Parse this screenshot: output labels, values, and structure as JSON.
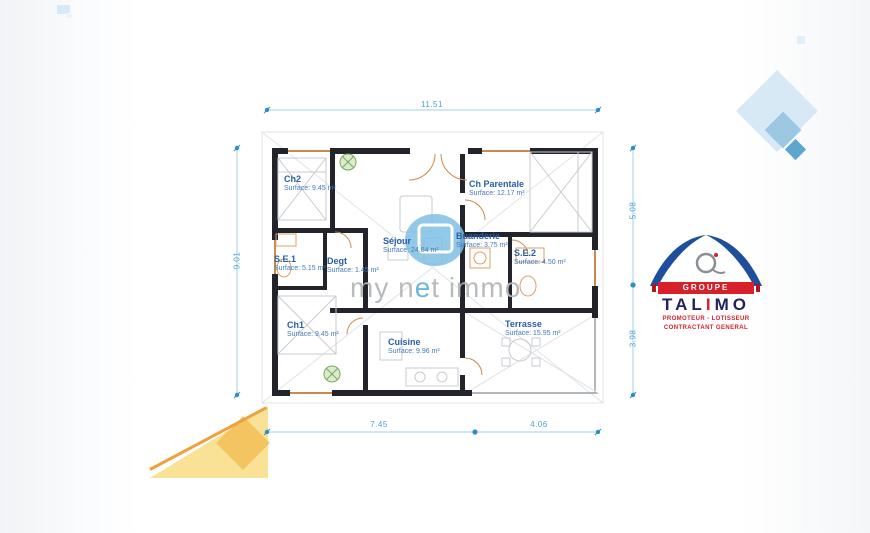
{
  "dimensions": {
    "top": "11.51",
    "left": "9.01",
    "right_upper": "5.08",
    "right_lower": "3.98",
    "bottom_left": "7.45",
    "bottom_right": "4.06"
  },
  "rooms": [
    {
      "name": "Ch2",
      "surface": "Surface: 9.45 m²"
    },
    {
      "name": "Ch Parentale",
      "surface": "Surface: 12.17 m²"
    },
    {
      "name": "Séjour",
      "surface": "Surface: 24.84 m²"
    },
    {
      "name": "Buanderie",
      "surface": "Surface: 3.75 m²"
    },
    {
      "name": "S.E.1",
      "surface": "Surface: 5.15 m²"
    },
    {
      "name": "Degt",
      "surface": "Surface: 1.45 m²"
    },
    {
      "name": "S.E.2",
      "surface": "Surface: 4.50 m²"
    },
    {
      "name": "Ch1",
      "surface": "Surface: 9.45 m²"
    },
    {
      "name": "Cuisine",
      "surface": "Surface: 9.96 m²"
    },
    {
      "name": "Terrasse",
      "surface": "Surface: 15.95 m²"
    }
  ],
  "watermark": {
    "prefix": "my n",
    "accent": "e",
    "suffix": "t immo"
  },
  "logo": {
    "groupe": "GROUPE",
    "talimo": [
      "TAL",
      "I",
      "MO"
    ],
    "subtitle1": "PROMOTEUR - LOTISSEUR",
    "subtitle2": "CONTRACTANT GENERAL"
  },
  "colors": {
    "dimension_blue": "#4aa3cf",
    "room_label_blue": "#2a5fa8",
    "wall_dark": "#23232b",
    "door_orange": "#c98a4e",
    "logo_red": "#d6212b",
    "logo_navy": "#1e4f9c",
    "decor_light_blue": "#d7e9f5",
    "decor_yellow": "#f9e195"
  }
}
